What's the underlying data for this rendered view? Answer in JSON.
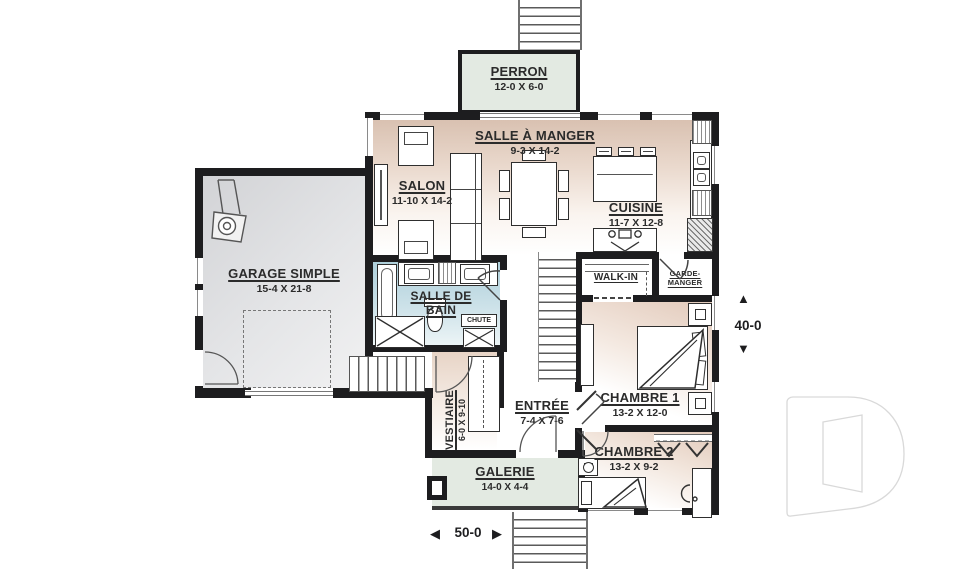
{
  "rooms": {
    "perron": {
      "name": "PERRON",
      "size": "12-0 X 6-0"
    },
    "salle_a_manger": {
      "name": "SALLE À MANGER",
      "size": "9-3 X 14-2"
    },
    "salon": {
      "name": "SALON",
      "size": "11-10 X 14-2"
    },
    "cuisine": {
      "name": "CUISINE",
      "size": "11-7 X 12-8"
    },
    "garage": {
      "name": "GARAGE SIMPLE",
      "size": "15-4 X 21-8"
    },
    "salle_de_bain": {
      "name": "SALLE DE BAIN"
    },
    "walk_in": {
      "name": "WALK-IN"
    },
    "garde_manger": {
      "name": "GARDE-MANGER"
    },
    "chute": {
      "name": "CHUTE"
    },
    "chambre1": {
      "name": "CHAMBRE 1",
      "size": "13-2 X 12-0"
    },
    "entree": {
      "name": "ENTRÉE",
      "size": "7-4 X 7-6"
    },
    "vestiaire": {
      "name": "VESTIAIRE",
      "size": "6-0 X 9-10"
    },
    "chambre2": {
      "name": "CHAMBRE 2",
      "size": "13-2 X 9-2"
    },
    "galerie": {
      "name": "GALERIE",
      "size": "14-0 X 4-4"
    }
  },
  "dimensions": {
    "depth": {
      "value": "40-0",
      "arrow_up": "▲",
      "arrow_down": "▼"
    },
    "width": {
      "value": "50-0",
      "arrow_left": "◀",
      "arrow_right": "▶"
    }
  },
  "watermark": {
    "icon": "drummond-d-logo"
  },
  "colors": {
    "wall": "#1d1d1f",
    "text": "#2b2b2b",
    "warm": "#d9c1b1",
    "bath": "#aecfda",
    "porch": "#e3eae2",
    "garage_fill": "#d8d9db",
    "watermark": "#d9d9d9"
  }
}
